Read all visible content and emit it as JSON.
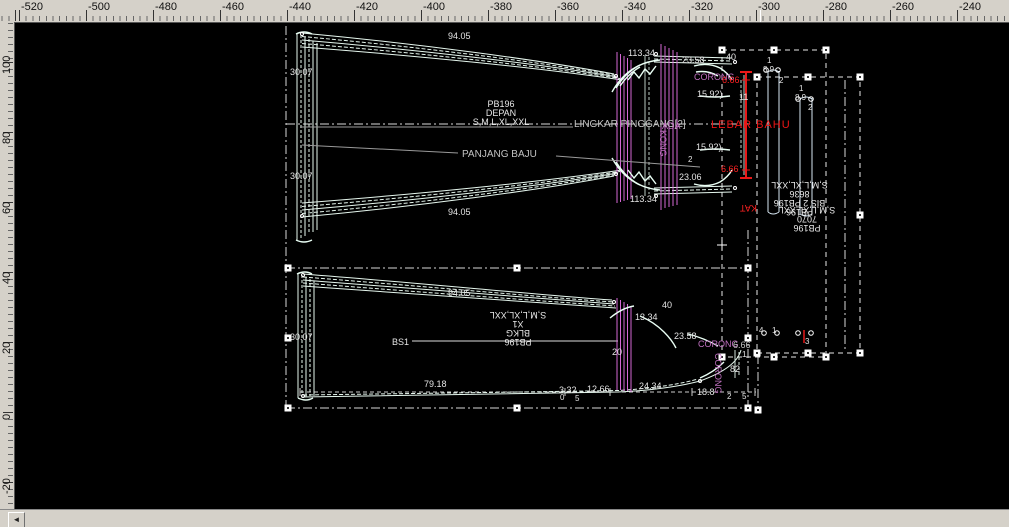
{
  "rulers": {
    "top": [
      "-520",
      "-500",
      "-480",
      "-460",
      "-440",
      "-420",
      "-400",
      "-380",
      "-360",
      "-340",
      "-320",
      "-300",
      "-280",
      "-260",
      "-240"
    ],
    "left": [
      "100",
      "80",
      "60",
      "40",
      "20",
      "0",
      "-20"
    ]
  },
  "scrollbar": {
    "left_arrow": "◄"
  },
  "front_label": {
    "line1": "PB196",
    "line2": "DEPAN",
    "line3": "S,M,L,XL,XXL"
  },
  "back_label": {
    "line1": "PB196",
    "line2": "BLKG",
    "line3": "X1",
    "line4": "S,M,L,XL,XXL"
  },
  "strip_label_a": {
    "line1": "PB196",
    "line2": "BIS 2 PB196",
    "line3": "8636",
    "line4": "S,M,L,XL,XXL"
  },
  "strip_label_b": {
    "line1": "PB196",
    "line2": "7070",
    "line3": "S,M,L,XL,XXL"
  },
  "strip_label_red": "KAT",
  "ann": [
    "94.05",
    "30.07",
    "30.07",
    "94.05",
    "PANJANG BAJU",
    "LINGKAR PINGGANG[2]",
    "ADA",
    "KONG",
    "113.34",
    "23.58",
    "CORONG",
    "6.66",
    "40",
    "15.92)",
    "11",
    "LEBAR BAHU",
    "15.92)",
    "2",
    "23.06",
    "6.66",
    "113.34",
    "BS1",
    "94.05",
    "30.07",
    "13.34",
    "40",
    "20",
    "23.58",
    "CORONG",
    "6.66",
    "79.18",
    "3.32",
    "12.66",
    "24.34",
    "18.8",
    "0",
    "5",
    "CORONG",
    "82",
    "1",
    "2",
    "5",
    "4",
    "1",
    "3",
    "1",
    "8.9",
    "2",
    "1",
    "8.9",
    "2"
  ],
  "colors": {
    "canvas": "#000000",
    "ruler_bg": "#d5d1c9",
    "nest_line": "#e6f7ee",
    "grade_line": "#d468d4",
    "accent_red": "#f02020",
    "purple_text": "#c070c0"
  }
}
